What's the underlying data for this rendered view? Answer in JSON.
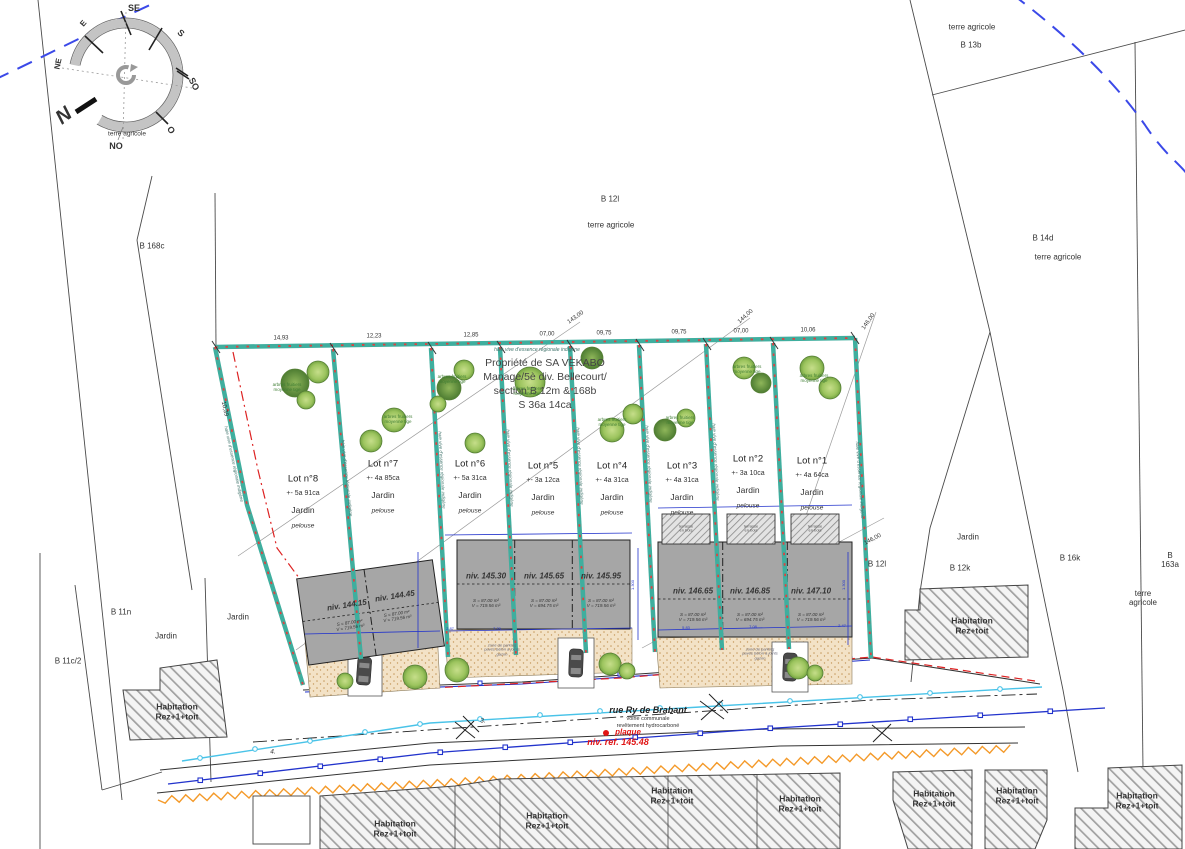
{
  "title": {
    "owner": "Propriété de SA VEKABO",
    "division": "Manage/5è div. Bellecourt/",
    "section": "section B 12m & 168b",
    "surface": "S  36a 14ca"
  },
  "compass": {
    "north": "N",
    "se": "SE",
    "s": "S",
    "so": "SO",
    "o": "O",
    "no": "NO",
    "ne": "NE",
    "e": "E",
    "note": "terre agricole"
  },
  "lots": [
    {
      "name": "Lot n°8",
      "area": "+- 5a 91ca",
      "garden": "Jardin",
      "ground": "pelouse"
    },
    {
      "name": "Lot n°7",
      "area": "+- 4a 85ca",
      "garden": "Jardin",
      "ground": "pelouse"
    },
    {
      "name": "Lot n°6",
      "area": "+- 5a 31ca",
      "garden": "Jardin",
      "ground": "pelouse"
    },
    {
      "name": "Lot n°5",
      "area": "+- 3a 12ca",
      "garden": "Jardin",
      "ground": "pelouse"
    },
    {
      "name": "Lot n°4",
      "area": "+- 4a 31ca",
      "garden": "Jardin",
      "ground": "pelouse"
    },
    {
      "name": "Lot n°3",
      "area": "+- 4a 31ca",
      "garden": "Jardin",
      "ground": "pelouse"
    },
    {
      "name": "Lot n°2",
      "area": "+- 3a 10ca",
      "garden": "Jardin",
      "ground": "pelouse"
    },
    {
      "name": "Lot n°1",
      "area": "+- 4a 64ca",
      "garden": "Jardin",
      "ground": "pelouse"
    }
  ],
  "buildings": [
    {
      "level": "niv. 144.15",
      "details": "S = 87.00 m²\nV = 719.56 m³"
    },
    {
      "level": "niv. 144.45",
      "details": "S = 87.00 m²\nV = 719.56 m³"
    },
    {
      "level": "niv. 145.30",
      "details": "S = 87.00 m²\nV = 719.56 m³"
    },
    {
      "level": "niv. 145.65",
      "details": "S = 87.00 m²\nV = 694.75 m³"
    },
    {
      "level": "niv. 145.95",
      "details": "S = 87.00 m²\nV = 719.56 m³"
    },
    {
      "level": "niv. 146.65",
      "details": "S = 87.00 m²\nV = 719.56 m³"
    },
    {
      "level": "niv. 146.85",
      "details": "S = 87.00 m²\nV = 694.75 m³"
    },
    {
      "level": "niv. 147.10",
      "details": "S = 87.00 m²\nV = 719.56 m³"
    }
  ],
  "terrace": "terrasse\nen bois",
  "hedge_label": "haie vive d'essence régionale indigène",
  "trees_label": "arbres fruitiers\nmoyenne tige",
  "parking_label": "zone de parking\npavés béton à joints\ngazon",
  "parcels": {
    "b168c": "B 168c",
    "b12l": "B 12l",
    "b13b": "B 13b",
    "b14d": "B 14d",
    "b12l2": "B 12l",
    "b12k": "B 12k",
    "b16k": "B 16k",
    "b163a": "B 163a",
    "b11n": "B 11n",
    "b11c2": "B 11c/2",
    "terre": "terre agricole",
    "jardin": "Jardin"
  },
  "dims": {
    "top": [
      "14,93",
      "12,23",
      "12,85",
      "07,00",
      "09,75",
      "09,75",
      "07,00",
      "10,06"
    ],
    "left": "10,39",
    "front": [
      "2.87",
      "7.29",
      "5.83",
      "7.08",
      "2.47"
    ],
    "vert": "1.300"
  },
  "contours": {
    "c143": "143,00",
    "c144": "144,00",
    "c146": "146,00"
  },
  "street": {
    "name": "rue Ry de Brabant",
    "admin": "voirie communale",
    "coating": "revêtement hydrocarboné",
    "plaque": "plaque",
    "ref_level": "niv. ref. 145.48",
    "pt3": "3.",
    "pt4": "4."
  },
  "habitations": {
    "r1": "Habitation\nRez+1+toit",
    "r0": "Habitation\nRez+toit"
  }
}
